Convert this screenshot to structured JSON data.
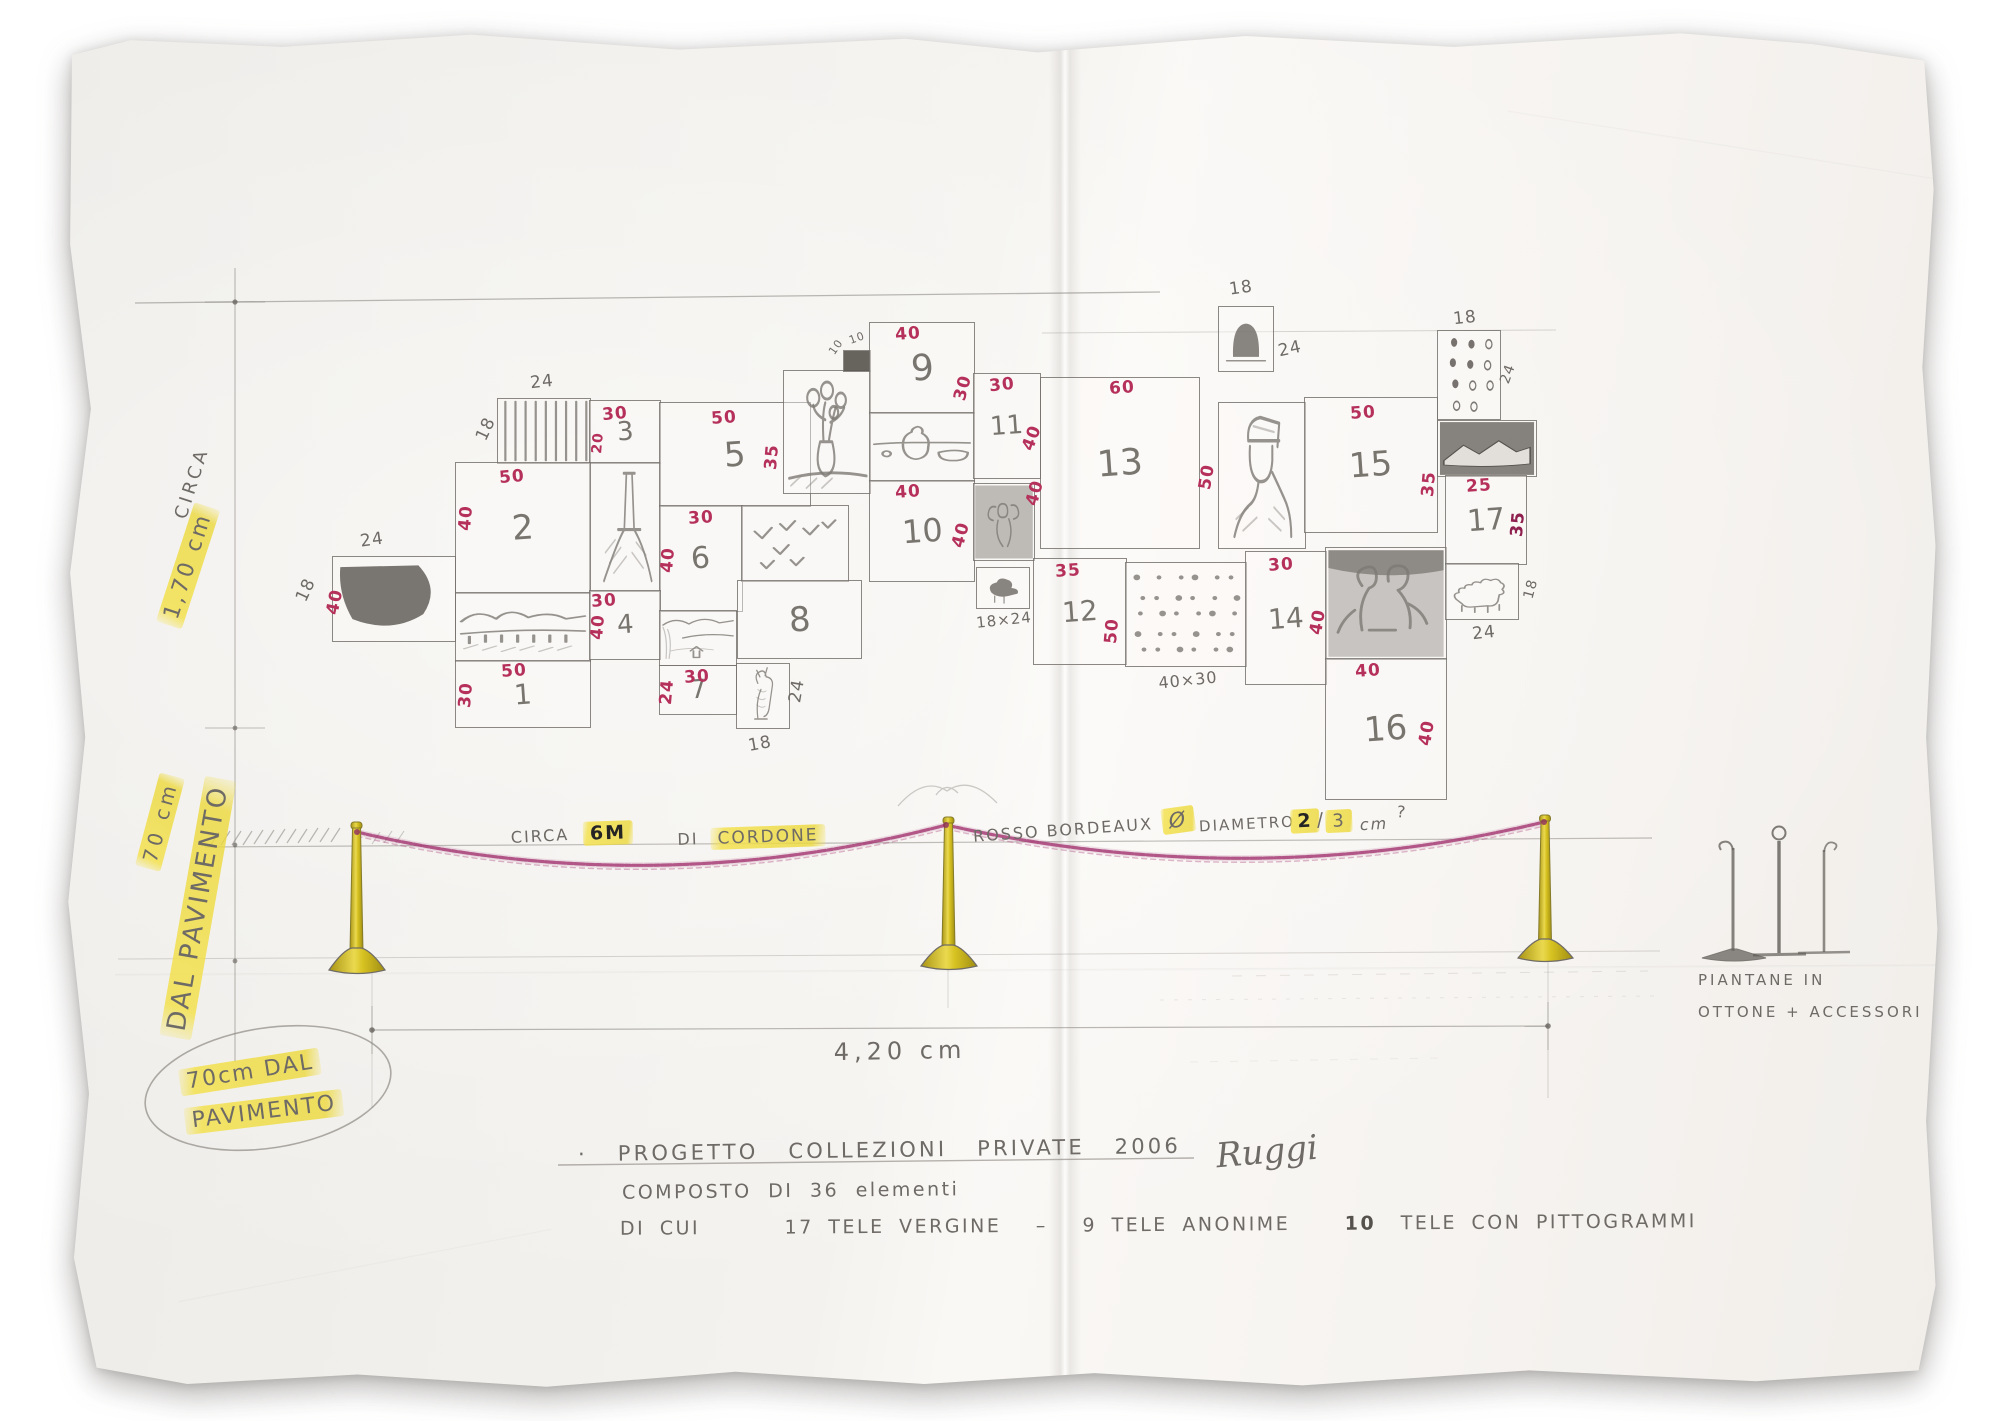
{
  "colors": {
    "red": "#b5305a",
    "darkred": "#8e1f4e",
    "pencil": "#6e6a66",
    "rope": "#a23570",
    "post": "#d8c324",
    "highlight": "#f3e14f"
  },
  "left_margin": {
    "circa_label": "CIRCA",
    "height_label": "1,70 cm",
    "floor_height_label": "70 cm",
    "from_floor_label": "DAL PAVIMENTO"
  },
  "floor_note": {
    "line1": "70cm DAL",
    "line2": "PAVIMENTO"
  },
  "rope_note": {
    "circa": "CIRCA",
    "length": "6M",
    "di": "DI",
    "cordone": "CORDONE",
    "color_note": "ROSSO BORDEAUX",
    "diameter_symbol": "Ø",
    "diameter_word": "DIAMETRO",
    "d1": "2",
    "slash": "/",
    "d2": "3",
    "unit": "cm",
    "question": "?"
  },
  "span_label": "4,20 cm",
  "stand_note": {
    "line1": "PIANTANE IN",
    "line2": "OTTONE + ACCESSORI"
  },
  "footer": {
    "bullet": "·",
    "title": "PROGETTO COLLEZIONI PRIVATE 2006",
    "signature": "Ruggi",
    "line2": "COMPOSTO DI 36 elementi",
    "line3_a": "DI CUI",
    "line3_b": "17 TELE VERGINE",
    "line3_dash": "–",
    "line3_c": "9 TELE ANONIME",
    "line3_d": "10",
    "line3_e": "TELE CON PITTOGRAMMI"
  },
  "canvases": [
    {
      "id": "dark",
      "x": 332,
      "y": 556,
      "w": 122,
      "h": 84,
      "sketch": "dark"
    },
    {
      "id": "radiator",
      "x": 497,
      "y": 398,
      "w": 92,
      "h": 64,
      "sketch": "stripes"
    },
    {
      "id": "n3",
      "x": 589,
      "y": 400,
      "w": 70,
      "h": 62,
      "num": "3",
      "nfs": 26
    },
    {
      "id": "tower",
      "x": 589,
      "y": 462,
      "w": 70,
      "h": 128,
      "sketch": "tower"
    },
    {
      "id": "n2",
      "x": 455,
      "y": 462,
      "w": 134,
      "h": 130,
      "num": "2",
      "nfs": 34
    },
    {
      "id": "n5",
      "x": 659,
      "y": 402,
      "w": 150,
      "h": 103,
      "num": "5",
      "nfs": 34
    },
    {
      "id": "n6",
      "x": 659,
      "y": 505,
      "w": 82,
      "h": 105,
      "num": "6",
      "nfs": 30
    },
    {
      "id": "landscape",
      "x": 455,
      "y": 592,
      "w": 134,
      "h": 68,
      "sketch": "landscape"
    },
    {
      "id": "n1",
      "x": 455,
      "y": 660,
      "w": 134,
      "h": 66,
      "num": "1",
      "nfs": 28
    },
    {
      "id": "n4",
      "x": 589,
      "y": 590,
      "w": 70,
      "h": 68,
      "num": "4",
      "nfs": 26
    },
    {
      "id": "river",
      "x": 659,
      "y": 610,
      "w": 76,
      "h": 54,
      "sketch": "river"
    },
    {
      "id": "n7",
      "x": 659,
      "y": 665,
      "w": 76,
      "h": 48,
      "num": "7",
      "nfs": 26
    },
    {
      "id": "dog",
      "x": 736,
      "y": 663,
      "w": 52,
      "h": 64,
      "sketch": "dog"
    },
    {
      "id": "birds",
      "x": 741,
      "y": 505,
      "w": 106,
      "h": 75,
      "sketch": "birds"
    },
    {
      "id": "n8",
      "x": 737,
      "y": 580,
      "w": 123,
      "h": 77,
      "num": "8",
      "nfs": 34
    },
    {
      "id": "flowers",
      "x": 783,
      "y": 370,
      "w": 86,
      "h": 122,
      "sketch": "flowers"
    },
    {
      "id": "darksq",
      "x": 843,
      "y": 350,
      "w": 26,
      "h": 20,
      "sketch": "solid"
    },
    {
      "id": "n9",
      "x": 869,
      "y": 322,
      "w": 104,
      "h": 90,
      "num": "9",
      "nfs": 36
    },
    {
      "id": "stilllife",
      "x": 869,
      "y": 412,
      "w": 104,
      "h": 68,
      "sketch": "stilllife"
    },
    {
      "id": "n10",
      "x": 869,
      "y": 480,
      "w": 104,
      "h": 100,
      "num": "10",
      "nfs": 32
    },
    {
      "id": "n11",
      "x": 973,
      "y": 373,
      "w": 66,
      "h": 104,
      "num": "11",
      "nfs": 26
    },
    {
      "id": "angel",
      "x": 973,
      "y": 483,
      "w": 60,
      "h": 76,
      "sketch": "angel"
    },
    {
      "id": "smallbird",
      "x": 976,
      "y": 567,
      "w": 52,
      "h": 40,
      "sketch": "birdsm"
    },
    {
      "id": "n13",
      "x": 1040,
      "y": 377,
      "w": 158,
      "h": 170,
      "num": "13",
      "nfs": 36
    },
    {
      "id": "tophat",
      "x": 1218,
      "y": 306,
      "w": 54,
      "h": 64,
      "sketch": "tophat"
    },
    {
      "id": "portrait",
      "x": 1218,
      "y": 402,
      "w": 86,
      "h": 145,
      "sketch": "portrait"
    },
    {
      "id": "n15",
      "x": 1304,
      "y": 397,
      "w": 132,
      "h": 134,
      "num": "15",
      "nfs": 34
    },
    {
      "id": "dice",
      "x": 1437,
      "y": 330,
      "w": 62,
      "h": 88,
      "sketch": "dice"
    },
    {
      "id": "mountains",
      "x": 1437,
      "y": 420,
      "w": 98,
      "h": 55,
      "sketch": "mountains"
    },
    {
      "id": "n12",
      "x": 1033,
      "y": 558,
      "w": 92,
      "h": 105,
      "num": "12",
      "nfs": 28
    },
    {
      "id": "dots",
      "x": 1125,
      "y": 562,
      "w": 120,
      "h": 103,
      "sketch": "dots"
    },
    {
      "id": "n14",
      "x": 1245,
      "y": 551,
      "w": 80,
      "h": 132,
      "num": "14",
      "nfs": 28
    },
    {
      "id": "figures",
      "x": 1325,
      "y": 547,
      "w": 120,
      "h": 111,
      "sketch": "figures"
    },
    {
      "id": "n17",
      "x": 1445,
      "y": 475,
      "w": 80,
      "h": 88,
      "num": "17",
      "nfs": 30
    },
    {
      "id": "n16",
      "x": 1325,
      "y": 658,
      "w": 120,
      "h": 140,
      "num": "16",
      "nfs": 34
    },
    {
      "id": "lion",
      "x": 1445,
      "y": 563,
      "w": 72,
      "h": 55,
      "sketch": "lion"
    }
  ],
  "dim_labels": [
    {
      "t": "24",
      "x": 372,
      "y": 540,
      "r": -8,
      "c": "pencil"
    },
    {
      "t": "18",
      "x": 306,
      "y": 590,
      "r": -65,
      "c": "pencil"
    },
    {
      "t": "40",
      "x": 335,
      "y": 602,
      "r": -78,
      "c": "red"
    },
    {
      "t": "50",
      "x": 512,
      "y": 477,
      "r": -5,
      "c": "red"
    },
    {
      "t": "40",
      "x": 466,
      "y": 518,
      "r": -85,
      "c": "red"
    },
    {
      "t": "24",
      "x": 542,
      "y": 382,
      "r": -6,
      "c": "pencil"
    },
    {
      "t": "18",
      "x": 486,
      "y": 429,
      "r": -65,
      "c": "pencil"
    },
    {
      "t": "30",
      "x": 615,
      "y": 414,
      "r": -5,
      "c": "red"
    },
    {
      "t": "20",
      "x": 598,
      "y": 443,
      "r": -85,
      "c": "red",
      "fs": 14
    },
    {
      "t": "50",
      "x": 724,
      "y": 418,
      "r": -4,
      "c": "red"
    },
    {
      "t": "30",
      "x": 701,
      "y": 518,
      "r": -4,
      "c": "red"
    },
    {
      "t": "40",
      "x": 668,
      "y": 560,
      "r": -85,
      "c": "red"
    },
    {
      "t": "50",
      "x": 514,
      "y": 671,
      "r": -4,
      "c": "red"
    },
    {
      "t": "30",
      "x": 466,
      "y": 695,
      "r": -85,
      "c": "red"
    },
    {
      "t": "30",
      "x": 604,
      "y": 601,
      "r": -4,
      "c": "red"
    },
    {
      "t": "40",
      "x": 598,
      "y": 627,
      "r": -85,
      "c": "red"
    },
    {
      "t": "30",
      "x": 697,
      "y": 677,
      "r": -4,
      "c": "red"
    },
    {
      "t": "24",
      "x": 667,
      "y": 692,
      "r": -85,
      "c": "red"
    },
    {
      "t": "24",
      "x": 797,
      "y": 691,
      "r": -80,
      "c": "pencil"
    },
    {
      "t": "18",
      "x": 760,
      "y": 744,
      "r": -10,
      "c": "pencil"
    },
    {
      "t": "35",
      "x": 772,
      "y": 457,
      "r": -85,
      "c": "red"
    },
    {
      "t": "10",
      "x": 836,
      "y": 347,
      "r": -55,
      "c": "pencil",
      "fs": 11
    },
    {
      "t": "10",
      "x": 857,
      "y": 338,
      "r": -20,
      "c": "pencil",
      "fs": 11
    },
    {
      "t": "40",
      "x": 908,
      "y": 334,
      "r": -4,
      "c": "red"
    },
    {
      "t": "30",
      "x": 963,
      "y": 388,
      "r": -75,
      "c": "red"
    },
    {
      "t": "40",
      "x": 908,
      "y": 492,
      "r": -4,
      "c": "red"
    },
    {
      "t": "40",
      "x": 961,
      "y": 535,
      "r": -75,
      "c": "red"
    },
    {
      "t": "30",
      "x": 1002,
      "y": 385,
      "r": -6,
      "c": "red"
    },
    {
      "t": "40",
      "x": 1032,
      "y": 438,
      "r": -70,
      "c": "red"
    },
    {
      "t": "18×24",
      "x": 1004,
      "y": 620,
      "r": -6,
      "c": "pencil",
      "fs": 15
    },
    {
      "t": "60",
      "x": 1122,
      "y": 388,
      "r": -4,
      "c": "red"
    },
    {
      "t": "40",
      "x": 1035,
      "y": 493,
      "r": -75,
      "c": "red"
    },
    {
      "t": "50",
      "x": 1207,
      "y": 477,
      "r": -80,
      "c": "red"
    },
    {
      "t": "18",
      "x": 1241,
      "y": 288,
      "r": -8,
      "c": "pencil"
    },
    {
      "t": "24",
      "x": 1290,
      "y": 349,
      "r": -12,
      "c": "pencil"
    },
    {
      "t": "50",
      "x": 1363,
      "y": 413,
      "r": -4,
      "c": "red"
    },
    {
      "t": "35",
      "x": 1429,
      "y": 484,
      "r": -85,
      "c": "red"
    },
    {
      "t": "18",
      "x": 1465,
      "y": 318,
      "r": -6,
      "c": "pencil"
    },
    {
      "t": "24",
      "x": 1508,
      "y": 374,
      "r": -70,
      "c": "pencil",
      "fs": 14
    },
    {
      "t": "35",
      "x": 1068,
      "y": 571,
      "r": -4,
      "c": "red"
    },
    {
      "t": "50",
      "x": 1112,
      "y": 631,
      "r": -85,
      "c": "red"
    },
    {
      "t": "40×30",
      "x": 1188,
      "y": 680,
      "r": -6,
      "c": "pencil",
      "fs": 16
    },
    {
      "t": "30",
      "x": 1281,
      "y": 565,
      "r": -4,
      "c": "red"
    },
    {
      "t": "40",
      "x": 1318,
      "y": 622,
      "r": -80,
      "c": "red"
    },
    {
      "t": "25",
      "x": 1479,
      "y": 486,
      "r": -4,
      "c": "red"
    },
    {
      "t": "35",
      "x": 1518,
      "y": 524,
      "r": -85,
      "c": "darkred"
    },
    {
      "t": "40",
      "x": 1368,
      "y": 671,
      "r": -4,
      "c": "red"
    },
    {
      "t": "40",
      "x": 1427,
      "y": 733,
      "r": -80,
      "c": "red"
    },
    {
      "t": "18",
      "x": 1531,
      "y": 589,
      "r": -75,
      "c": "pencil",
      "fs": 14
    },
    {
      "t": "24",
      "x": 1484,
      "y": 633,
      "r": -6,
      "c": "pencil"
    }
  ]
}
